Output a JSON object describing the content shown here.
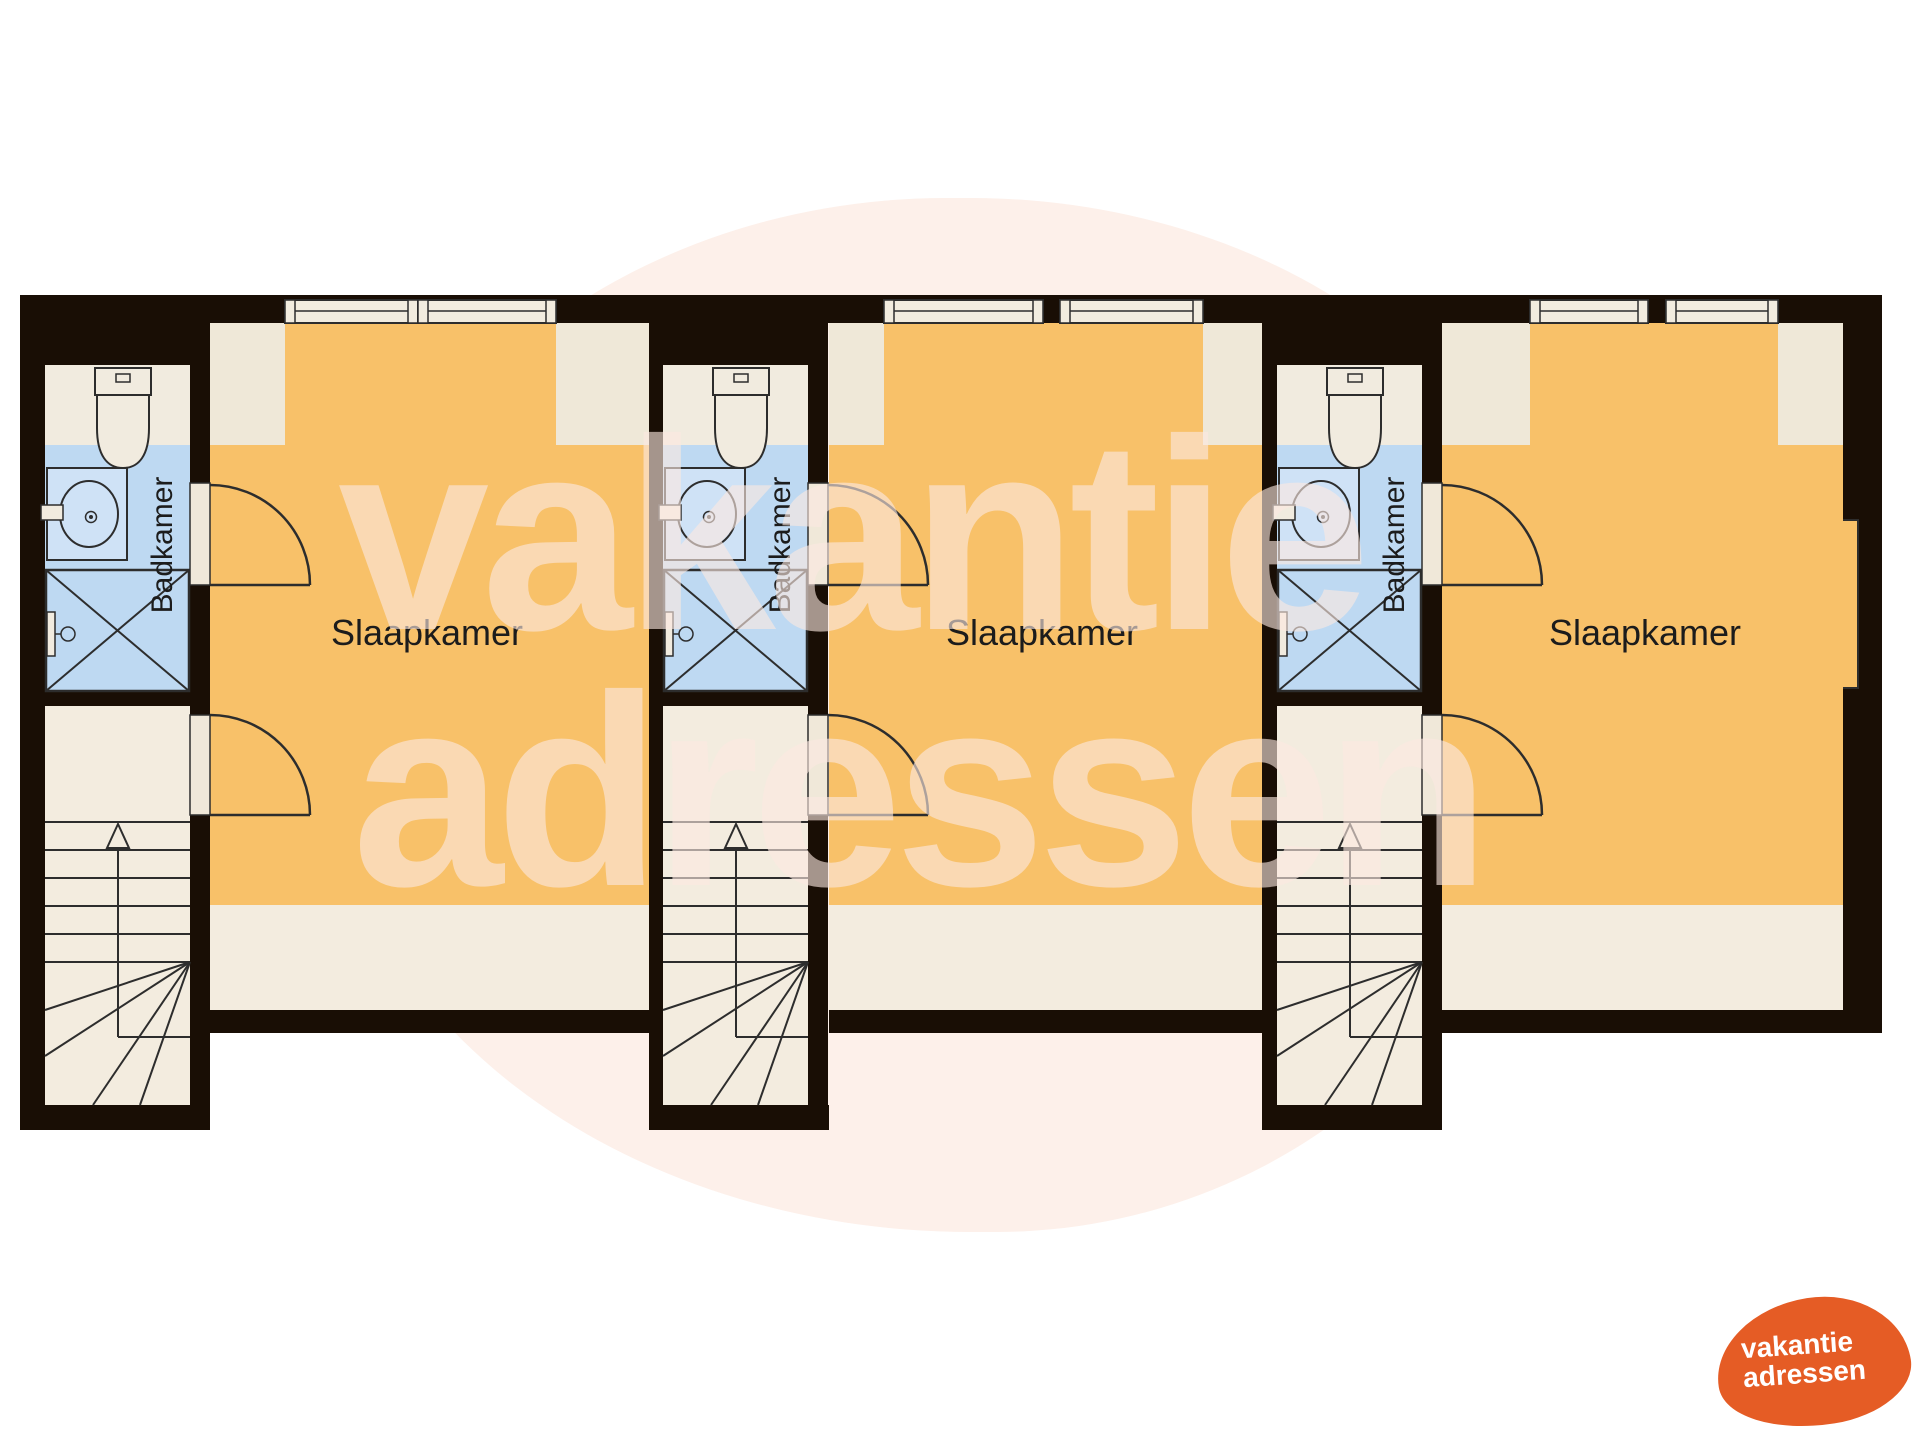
{
  "plan": {
    "units": [
      {
        "bedroom_label": "Slaapkamer",
        "bathroom_label": "Badkamer"
      },
      {
        "bedroom_label": "Slaapkamer",
        "bathroom_label": "Badkamer"
      },
      {
        "bedroom_label": "Slaapkamer",
        "bathroom_label": "Badkamer"
      }
    ]
  },
  "watermark": {
    "line1": "vakantie",
    "line2": "adressen"
  },
  "logo": {
    "line1": "vakantie",
    "line2": "adressen"
  },
  "colors": {
    "wall": "#190e05",
    "bedroom_floor": "#f8c169",
    "low_headroom": "#efe8d8",
    "hall_floor": "#f3ecdf",
    "bathroom_floor": "#f1ebdf",
    "bathroom_wet": "#bed9f2",
    "cabinet_fill": "#cfe2f6",
    "window_frame": "#f2ecdf",
    "door_jamb": "#f0e8d9",
    "fixture_line": "#2d2d2d",
    "label_text": "#1c1c1c",
    "watermark_pink": "rgba(252,233,224,0.62)",
    "blob_pink": "#fdf0ea",
    "logo_orange": "#e55c25",
    "logo_text_color": "#ffffff"
  }
}
